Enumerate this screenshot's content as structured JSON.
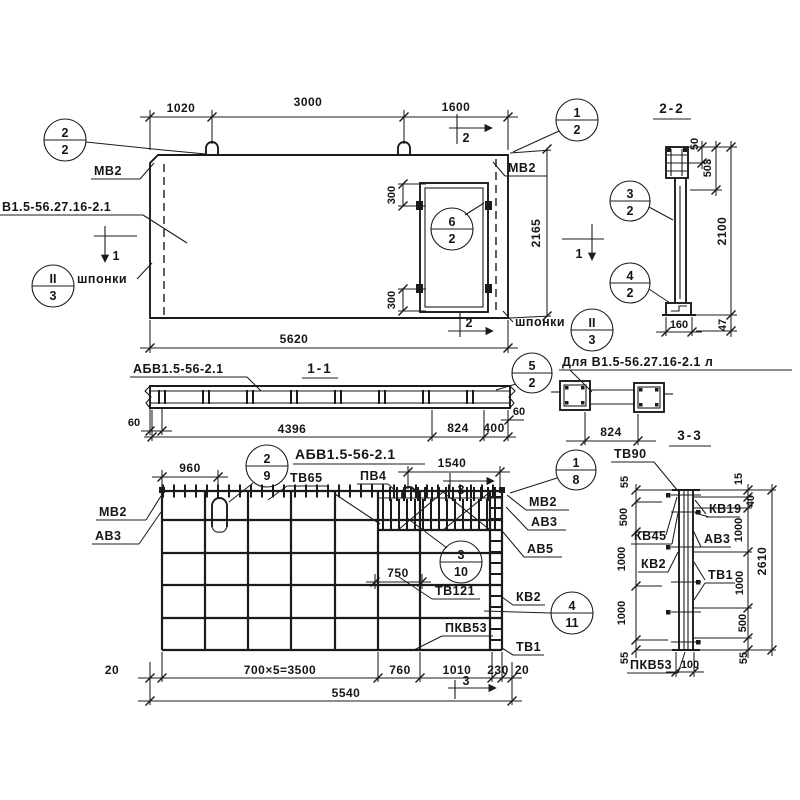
{
  "drawing": {
    "plan": {
      "mark": "В1.5-56.27.16-2.1",
      "mv2_left": "МВ2",
      "mv2_right": "МВ2",
      "shponki_left": "шпонки",
      "shponki_right": "шпонки",
      "dim_1020": "1020",
      "dim_3000": "3000",
      "dim_1600": "1600",
      "dim_2165": "2165",
      "dim_5620": "5620",
      "dim_300_top": "300",
      "dim_300_bot": "300",
      "sec1_left": "1",
      "sec1_right": "1",
      "sec2_top": "2",
      "sec2_bot": "2",
      "co_22_num": "2",
      "co_22_den": "2",
      "co_12_num": "1",
      "co_12_den": "2",
      "co_62_num": "6",
      "co_62_den": "2",
      "co_key_left_num": "II",
      "co_key_left_den": "3",
      "co_key_right_num": "II",
      "co_key_right_den": "3"
    },
    "sec22": {
      "title": "2-2",
      "dim_50": "50",
      "dim_503": "503",
      "dim_2100": "2100",
      "dim_47": "47",
      "dim_160": "160",
      "co_32_num": "3",
      "co_32_den": "2",
      "co_42_num": "4",
      "co_42_den": "2"
    },
    "sec11": {
      "mark": "АБВ1.5-56-2.1",
      "title": "1-1",
      "dim_60_left": "60",
      "dim_4396": "4396",
      "dim_824": "824",
      "dim_400": "400",
      "dim_60_right": "60",
      "variant_label": "Для В1.5-56.27.16-2.1 л",
      "dim_824_right": "824",
      "co_52_num": "5",
      "co_52_den": "2"
    },
    "rebar": {
      "title": "АБВ1.5-56-2.1",
      "dim_960": "960",
      "dim_1540": "1540",
      "dim_750": "750",
      "dim_20_left": "20",
      "dim_3500": "700×5=3500",
      "dim_760": "760",
      "dim_1010": "1010",
      "dim_230": "230",
      "dim_20_right": "20",
      "dim_5540": "5540",
      "sec3_top": "3",
      "sec3_bot": "3",
      "tv65": "ТВ65",
      "pv4": "ПВ4",
      "mv2_left": "МВ2",
      "av3_left": "АВ3",
      "mv2_right": "МВ2",
      "av3_right": "АВ3",
      "av5": "АВ5",
      "tv121": "ТВ121",
      "kv2": "КВ2",
      "pkv53": "ПКВ53",
      "tv1": "ТВ1",
      "co_29_num": "2",
      "co_29_den": "9",
      "co_18_num": "1",
      "co_18_den": "8",
      "co_310_num": "3",
      "co_310_den": "10",
      "co_411_num": "4",
      "co_411_den": "11"
    },
    "sec33": {
      "title": "3-3",
      "tv90": "ТВ90",
      "left_dims": [
        "55",
        "500",
        "1000",
        "1000",
        "55"
      ],
      "right_dims": [
        "15",
        "40",
        "1000",
        "1000",
        "500",
        "55"
      ],
      "dim_2610": "2610",
      "dim_100": "100",
      "kv45": "КВ45",
      "kv2": "КВ2",
      "pkv53": "ПКВ53",
      "kv19": "КВ19",
      "av3": "АВ3",
      "tv1": "ТВ1"
    }
  }
}
